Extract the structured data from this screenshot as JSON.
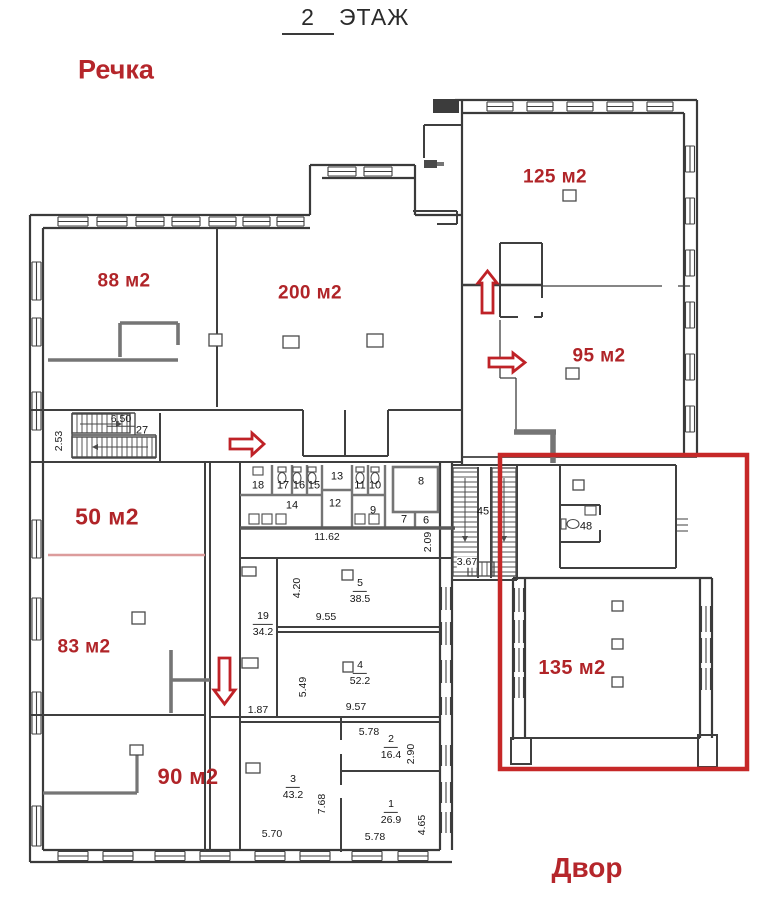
{
  "title": {
    "floor_number": "2",
    "floor_word": "ЭТАЖ"
  },
  "context": {
    "top_left": "Речка",
    "bottom_right": "Двор"
  },
  "colors": {
    "red_label": "#b02428",
    "highlight_box": "#c62828",
    "arrow": "#bf2227",
    "pink_line": "#dc9c9c"
  },
  "large_rooms": [
    {
      "label": "88 м2"
    },
    {
      "label": "200 м2"
    },
    {
      "label": "125 м2"
    },
    {
      "label": "95 м2"
    },
    {
      "label": "50 м2"
    },
    {
      "label": "83 м2"
    },
    {
      "label": "90 м2"
    },
    {
      "label": "135 м2"
    }
  ],
  "room_numbers": [
    "18",
    "17",
    "16",
    "15",
    "13",
    "11",
    "10",
    "14",
    "12",
    "9",
    "8",
    "7",
    "6",
    "45",
    "48",
    "27"
  ],
  "room_areas": [
    {
      "number": "19",
      "area": "34.2"
    },
    {
      "number": "5",
      "area": "38.5"
    },
    {
      "number": "4",
      "area": "52.2"
    },
    {
      "number": "2",
      "area": "16.4"
    },
    {
      "number": "3",
      "area": "43.2"
    },
    {
      "number": "1",
      "area": "26.9"
    }
  ],
  "dimensions": [
    "6.50",
    "2.53",
    "11.62",
    "2.09",
    "3.67",
    "4.20",
    "9.55",
    "5.49",
    "9.57",
    "1.87",
    "5.78",
    "2.90",
    "7.68",
    "5.70",
    "5.78",
    "4.65"
  ]
}
